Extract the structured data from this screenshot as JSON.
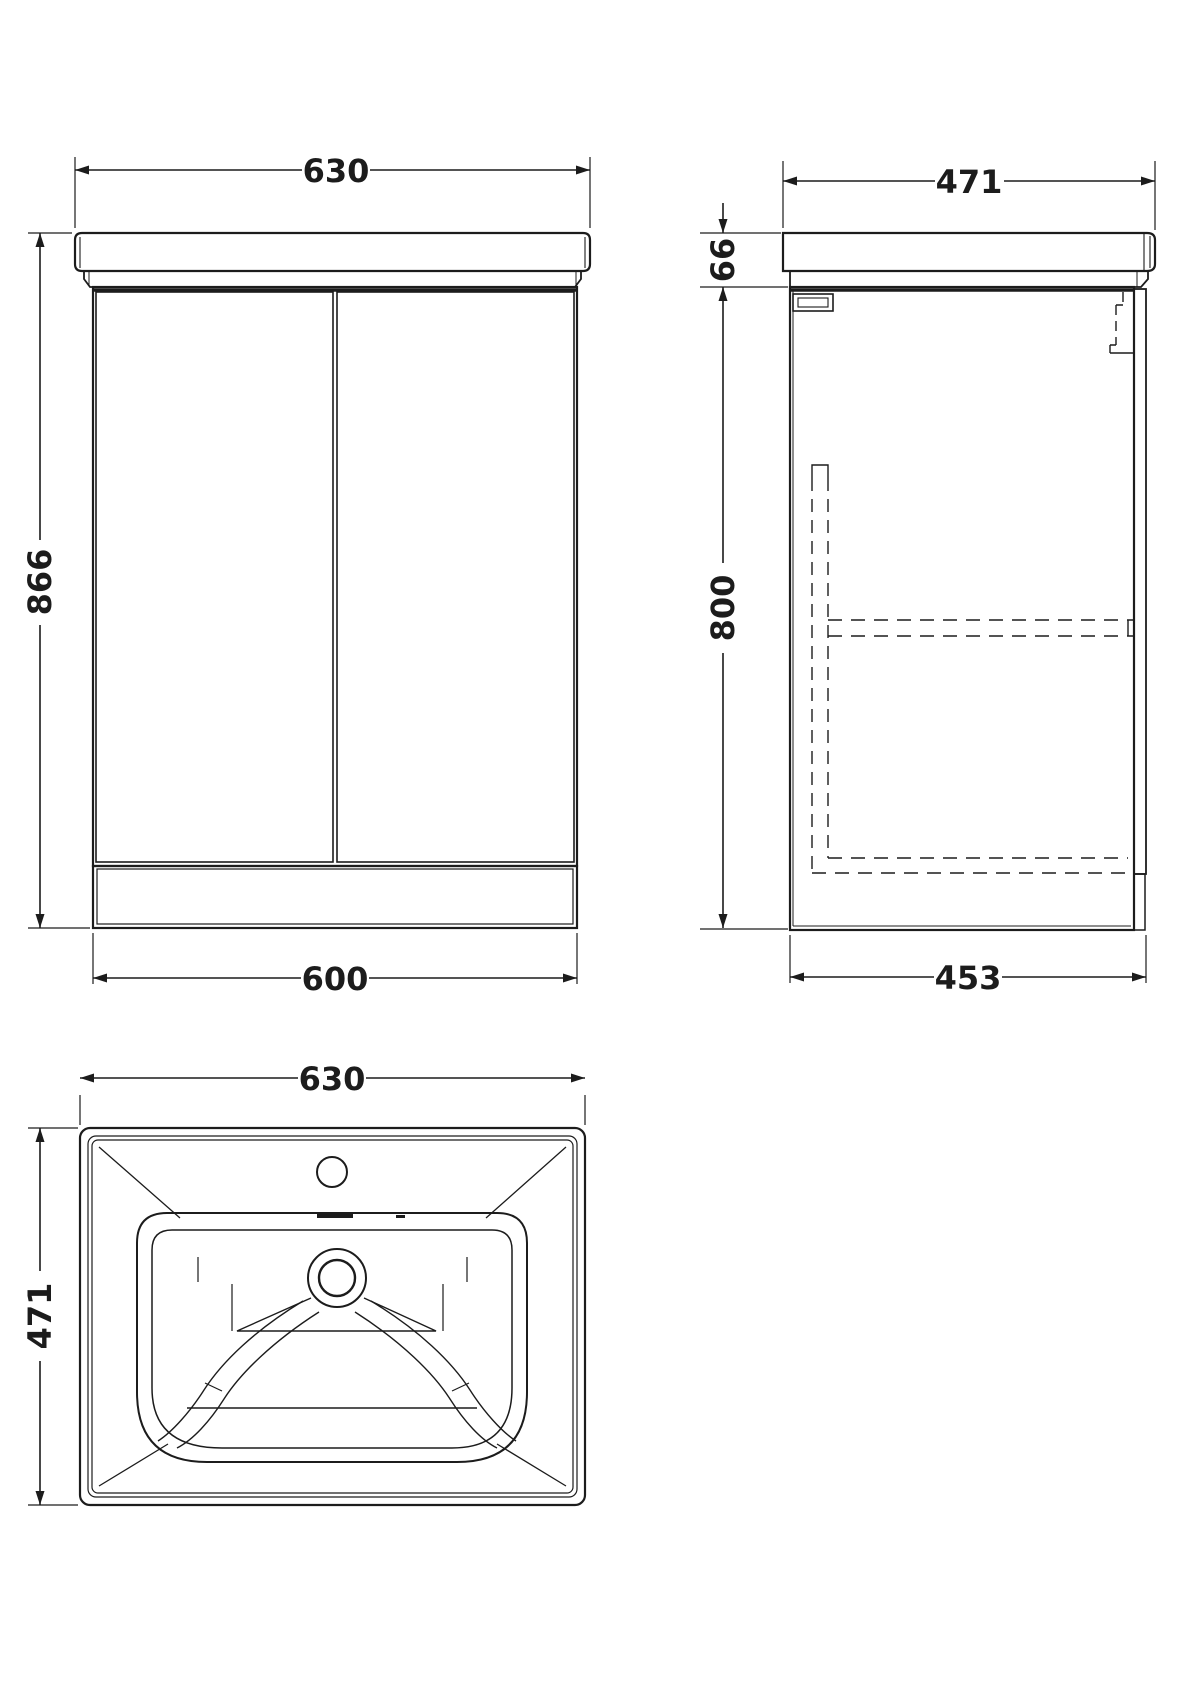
{
  "colors": {
    "line": "#1c1c1c",
    "background": "#ffffff"
  },
  "views": {
    "front": {
      "top_width": "630",
      "height": "866",
      "bottom_width": "600"
    },
    "side": {
      "top_depth": "471",
      "worktop_height": "66",
      "cabinet_height": "800",
      "bottom_depth": "453"
    },
    "plan": {
      "width": "630",
      "depth": "471"
    }
  }
}
